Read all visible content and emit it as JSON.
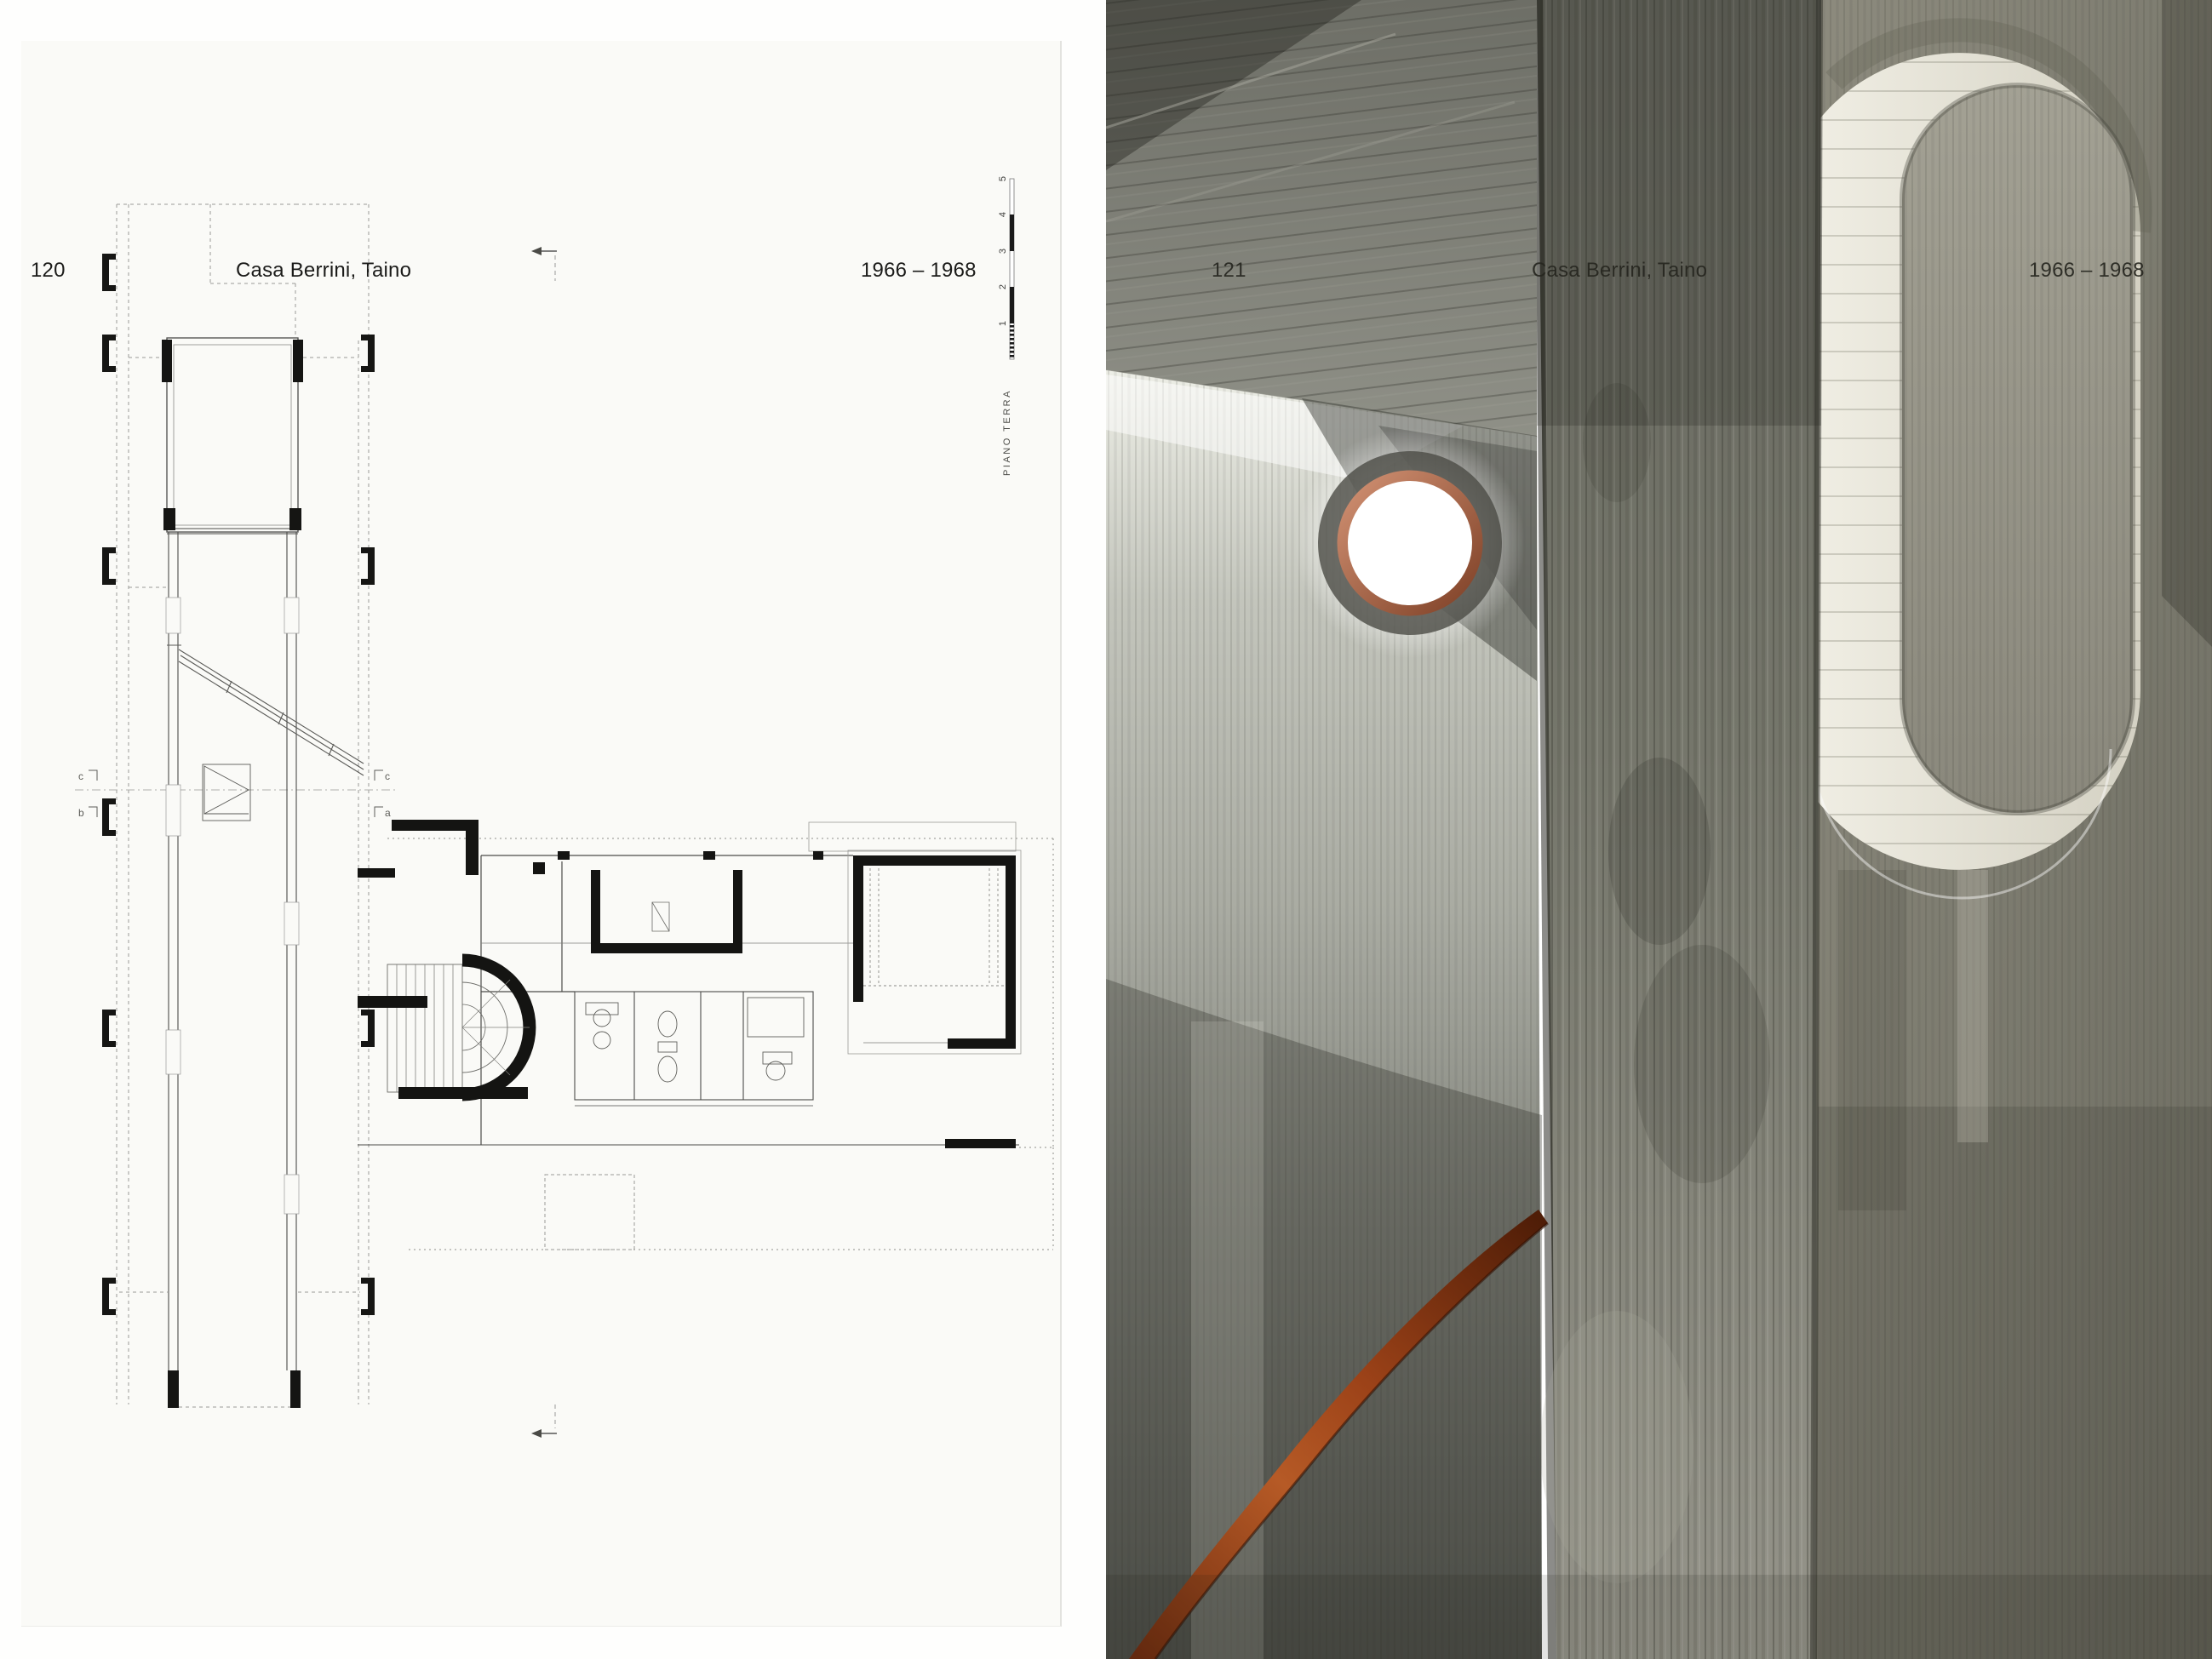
{
  "spread": {
    "left_page": {
      "page_number": "120",
      "title": "Casa Berrini, Taino",
      "dates": "1966 – 1968",
      "plan_caption": "PIANO TERRA",
      "scale_ticks": [
        "5",
        "4",
        "3",
        "2",
        "1"
      ]
    },
    "right_page": {
      "page_number": "121",
      "title": "Casa Berrini, Taino",
      "dates": "1966 – 1968"
    }
  },
  "colors": {
    "paper": "#fafaf7",
    "ink": "#1b1b19",
    "photo_caption_ink": "#26261f",
    "handrail_rust": "#9c4218",
    "porthole_copper": "#c08063",
    "concrete_light": "#b7b9b1",
    "concrete_dark": "#6b6c63"
  }
}
